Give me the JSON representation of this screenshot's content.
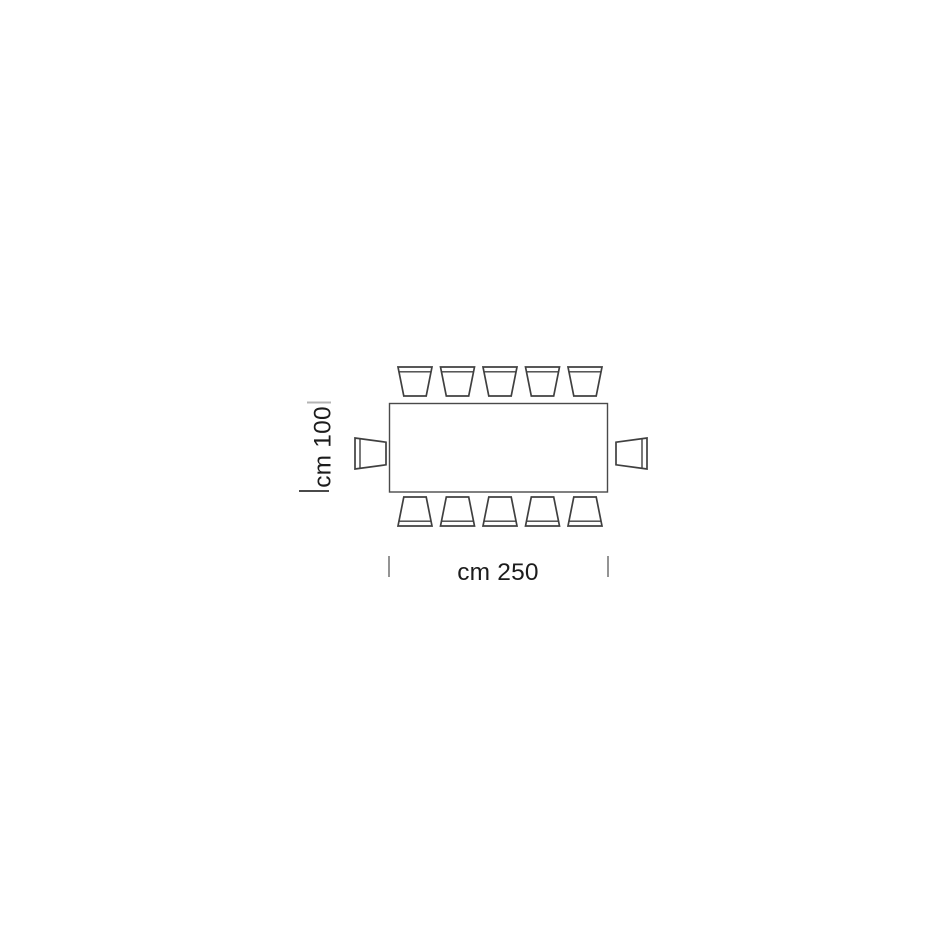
{
  "page": {
    "background": "#ffffff"
  },
  "diagram": {
    "type": "furniture-dimension-plan",
    "table": {
      "shape": "rectangle",
      "width_label": "cm 250",
      "depth_label": "cm 100",
      "width_cm": 250,
      "depth_cm": 100
    },
    "chairs": {
      "top": 5,
      "bottom": 5,
      "left": 1,
      "right": 1,
      "total": 12
    },
    "colors": {
      "line": "#404040",
      "table_outline": "#4a4a4a",
      "text": "#1c1c1c",
      "tick_light": "#b4b4b4",
      "tick_dark": "#4a4a4a",
      "tick_mid": "#7a7a7a",
      "background": "#ffffff"
    }
  }
}
